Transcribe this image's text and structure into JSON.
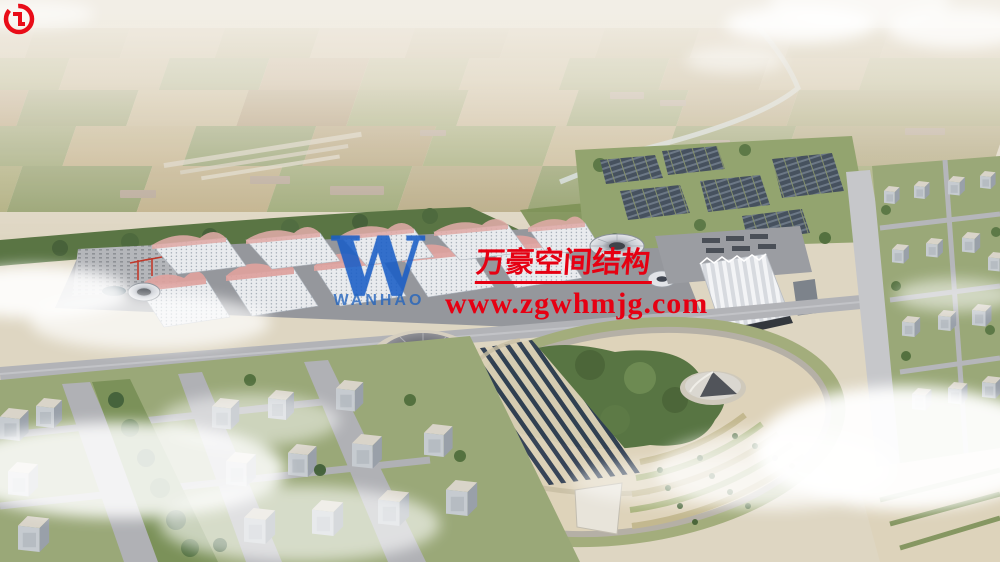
{
  "watermark": {
    "logo_monogram": "W",
    "logo_wordmark": "WANHAO",
    "company_cn": "万豪空间结构",
    "website": "www.zgwhmjg.com",
    "colors": {
      "watermark_red": "#e60012",
      "logo_blue": "#1a5ec6"
    }
  }
}
